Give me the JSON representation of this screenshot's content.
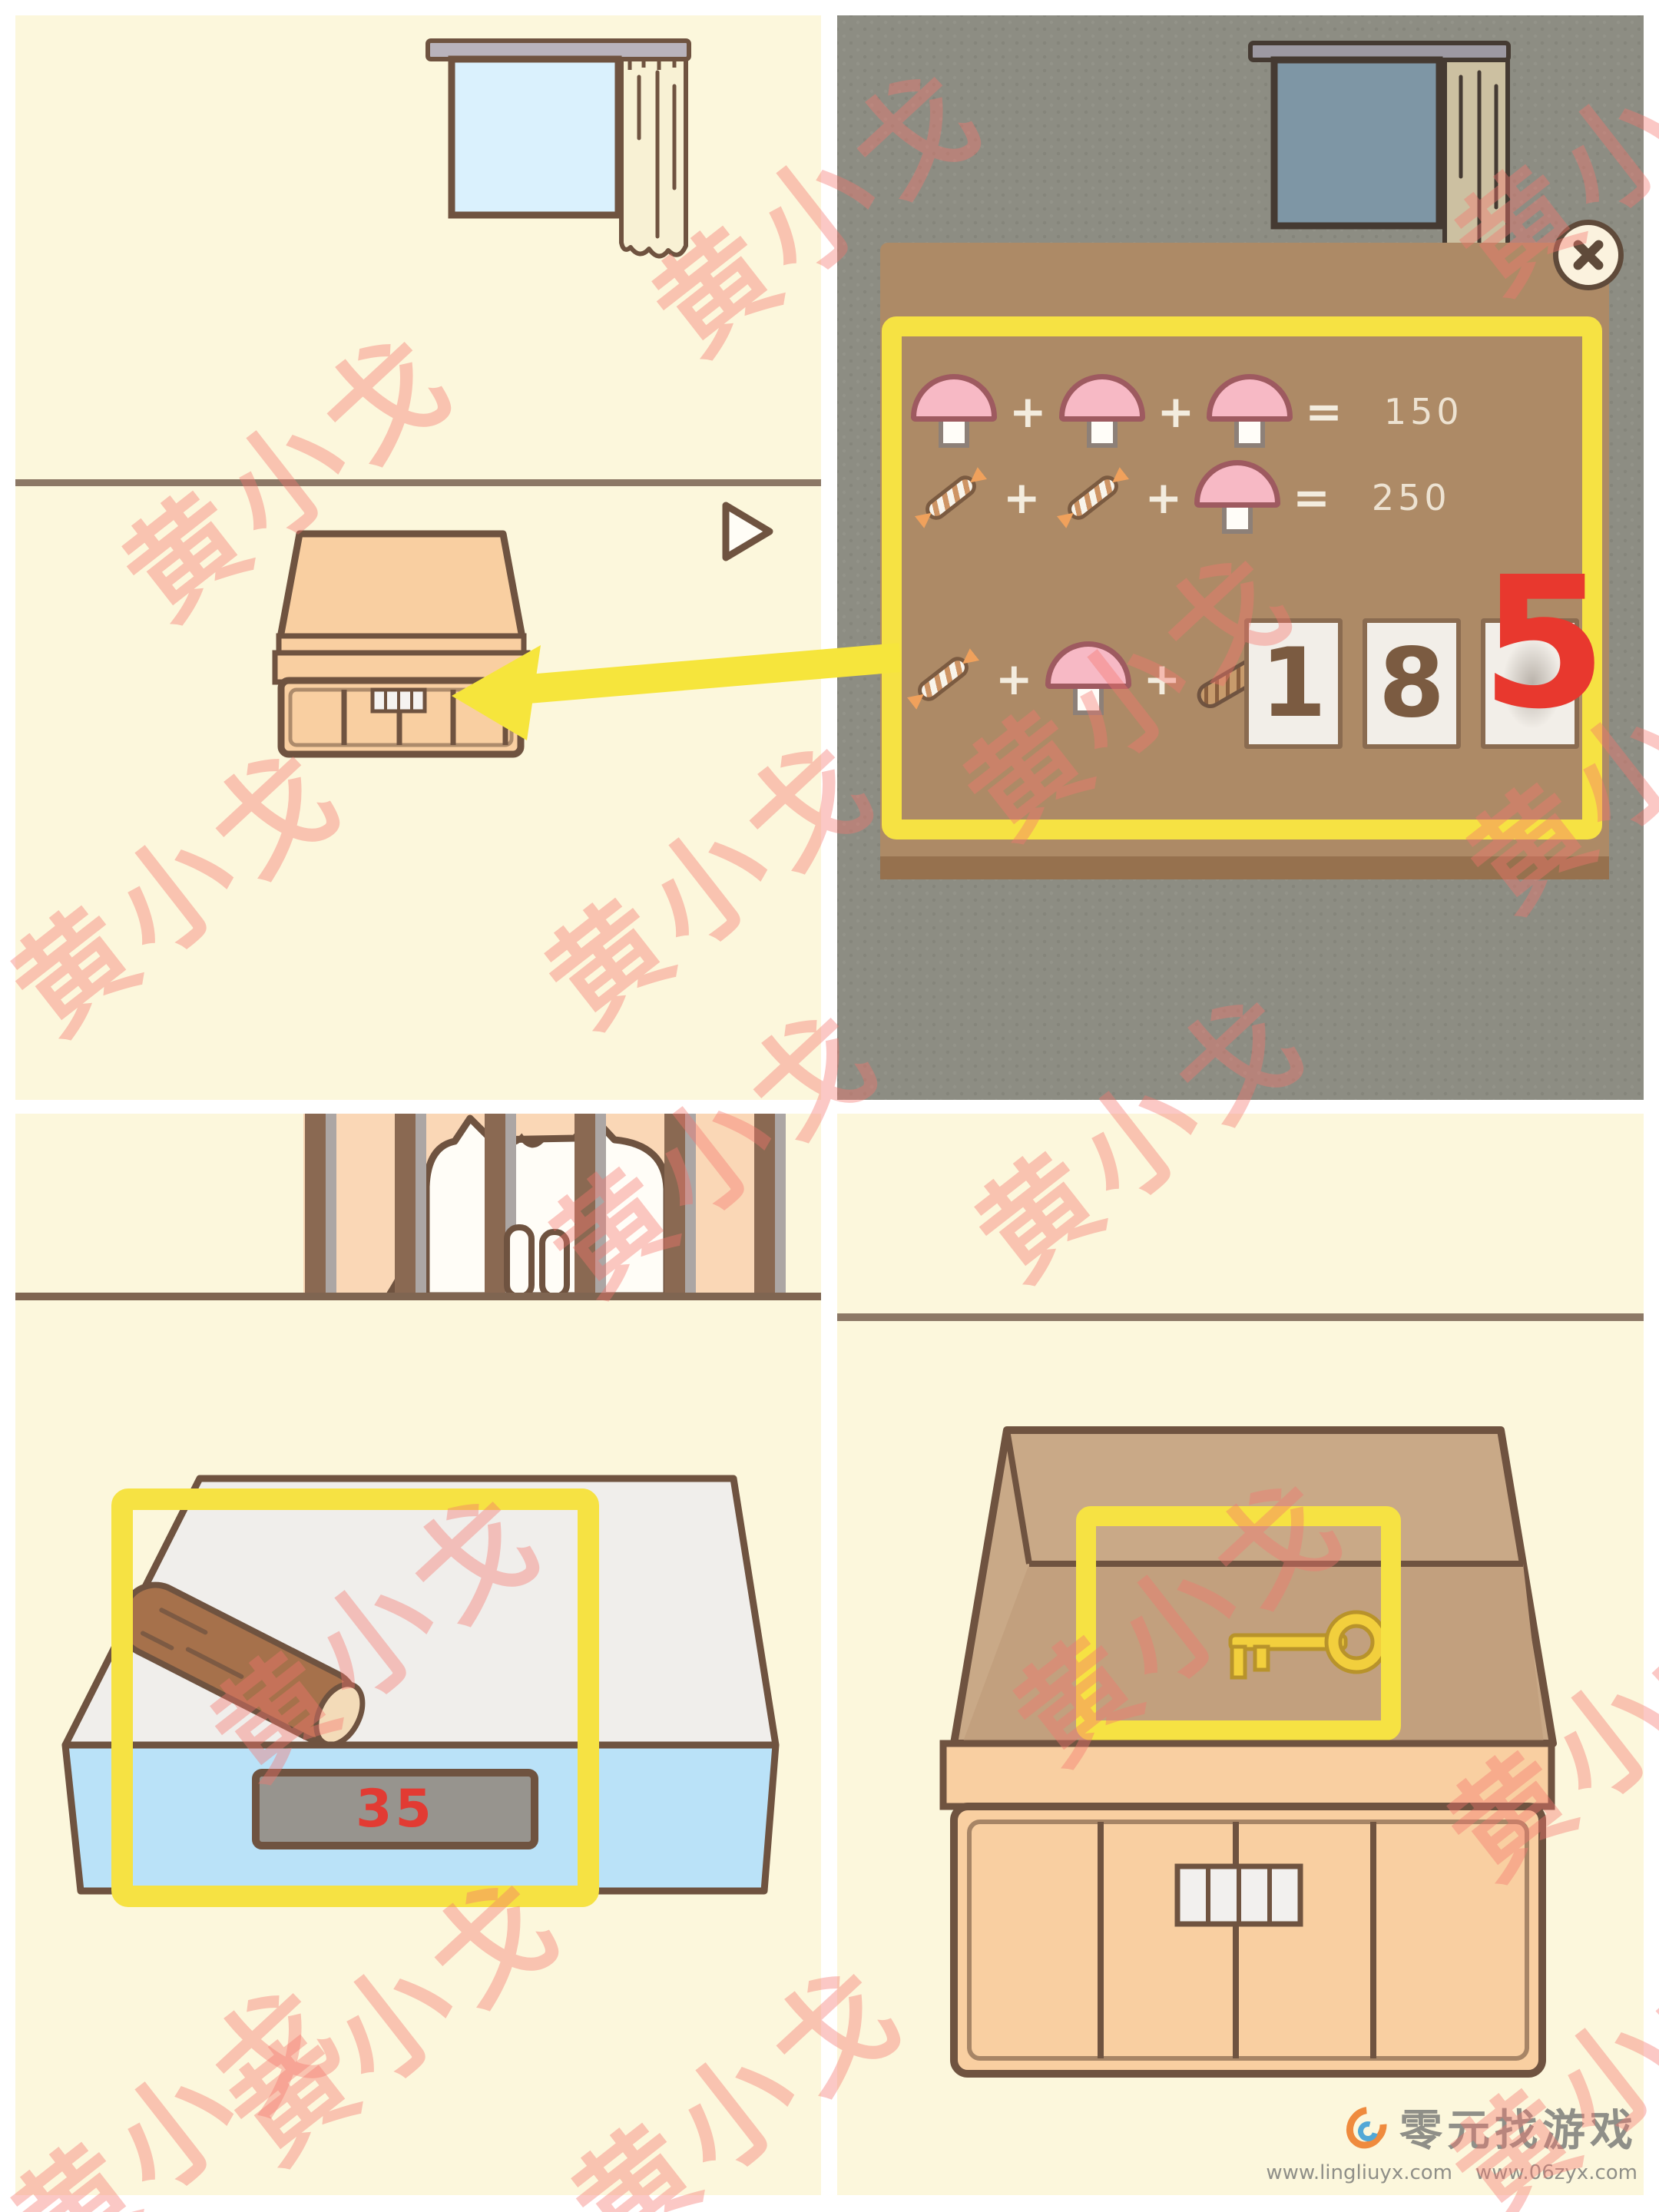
{
  "watermark": {
    "text": "黄小戈"
  },
  "footer": {
    "site_name": "零元找游戏",
    "urls": [
      "www.lingliuyx.com",
      "www.06zyx.com"
    ]
  },
  "puzzle": {
    "operators": {
      "plus": "+",
      "equals": "="
    },
    "rows": [
      {
        "tokens": [
          "mushroom-icon",
          "plus",
          "mushroom-icon",
          "plus",
          "mushroom-icon",
          "equals"
        ],
        "value": "150"
      },
      {
        "tokens": [
          "candy-icon",
          "plus",
          "candy-icon",
          "plus",
          "mushroom-icon",
          "equals"
        ],
        "value": "250"
      },
      {
        "tokens": [
          "candy-icon",
          "plus",
          "mushroom-icon",
          "plus",
          "cookie-icon",
          "equals"
        ],
        "value": ""
      }
    ],
    "answer_cards": [
      {
        "digit": "1",
        "style": "game-card"
      },
      {
        "digit": "8",
        "style": "game-card"
      },
      {
        "digit": "5",
        "style": "walkthrough-annotation-red"
      }
    ]
  },
  "scale": {
    "display_value": "35"
  },
  "locks": {
    "drawer_cells": 4,
    "box_cells": 4
  },
  "colors": {
    "panel_cream": "#FCF7DC",
    "panel_dark": "#8D8D83",
    "outline_brown": "#6F5340",
    "popup_brown": "#AD8A66",
    "highlight_yellow": "#F6E243",
    "arrow_yellow": "#F6E53C",
    "scale_blue": "#BAE2F8",
    "display_red": "#E23B33",
    "annotation_red": "#E8382E",
    "key_gold": "#F2CF3D",
    "mushroom_pink": "#F7B9C5"
  }
}
